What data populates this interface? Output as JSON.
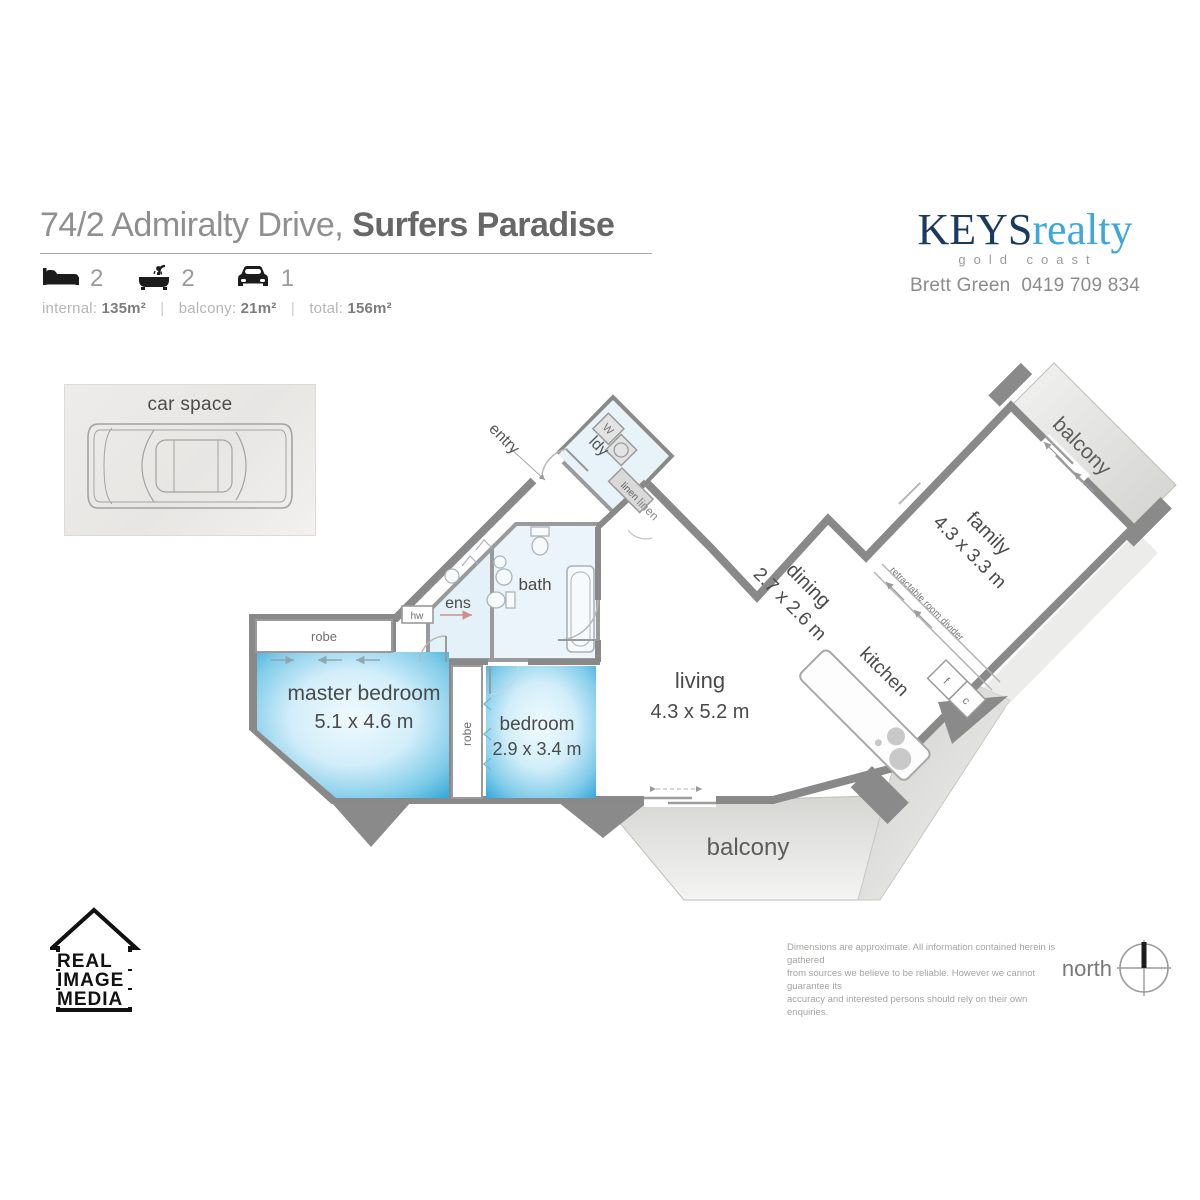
{
  "header": {
    "address_regular": "74/2 Admiralty Drive,",
    "address_bold": "Surfers Paradise",
    "features": {
      "beds": "2",
      "baths": "2",
      "cars": "1"
    },
    "areas": {
      "internal_label": "internal:",
      "internal_value": "135m²",
      "balcony_label": "balcony:",
      "balcony_value": "21m²",
      "total_label": "total:",
      "total_value": "156m²",
      "sep": "|"
    }
  },
  "agency": {
    "brand_primary": "KEYS",
    "brand_secondary": "realty",
    "tagline": "gold coast",
    "agent_line": "Brett Green  0419 709 834"
  },
  "car_space": {
    "label": "car space"
  },
  "rooms": {
    "master": {
      "name": "master bedroom",
      "dims": "5.1 x 4.6 m"
    },
    "bedroom": {
      "name": "bedroom",
      "dims": "2.9 x 3.4 m"
    },
    "living": {
      "name": "living",
      "dims": "4.3 x 5.2 m"
    },
    "dining": {
      "name": "dining",
      "dims": "2.7 x 2.6 m"
    },
    "family": {
      "name": "family",
      "dims": "4.3 x 3.3 m"
    },
    "kitchen": "kitchen",
    "bath": "bath",
    "ens": "ens",
    "laundry": "ldy",
    "entry": "entry",
    "balcony_top": "balcony",
    "balcony_bottom": "balcony"
  },
  "fixtures": {
    "robe_master": "robe",
    "robe_bedroom": "robe",
    "linen_top": "linen",
    "linen_hall": "linen",
    "hot_water": "hw",
    "washer": "W",
    "fridge": "f",
    "cupboard": "c",
    "divider": "retractable room divider"
  },
  "footer": {
    "media_lines": [
      "REAL",
      "IMAGE",
      "MEDIA"
    ],
    "disclaimer": [
      "Dimensions are approximate.  All information contained herein is gathered",
      "from sources we believe to be reliable.  However we cannot guarantee its",
      "accuracy and interested persons should rely on their own enquiries."
    ],
    "north_label": "north"
  },
  "colors": {
    "wall": "#898989",
    "highlight": "#3cadda",
    "balcony_fill": "#dcdcd9",
    "brand_navy": "#1a3a5e",
    "brand_blue": "#3fa8d8"
  }
}
